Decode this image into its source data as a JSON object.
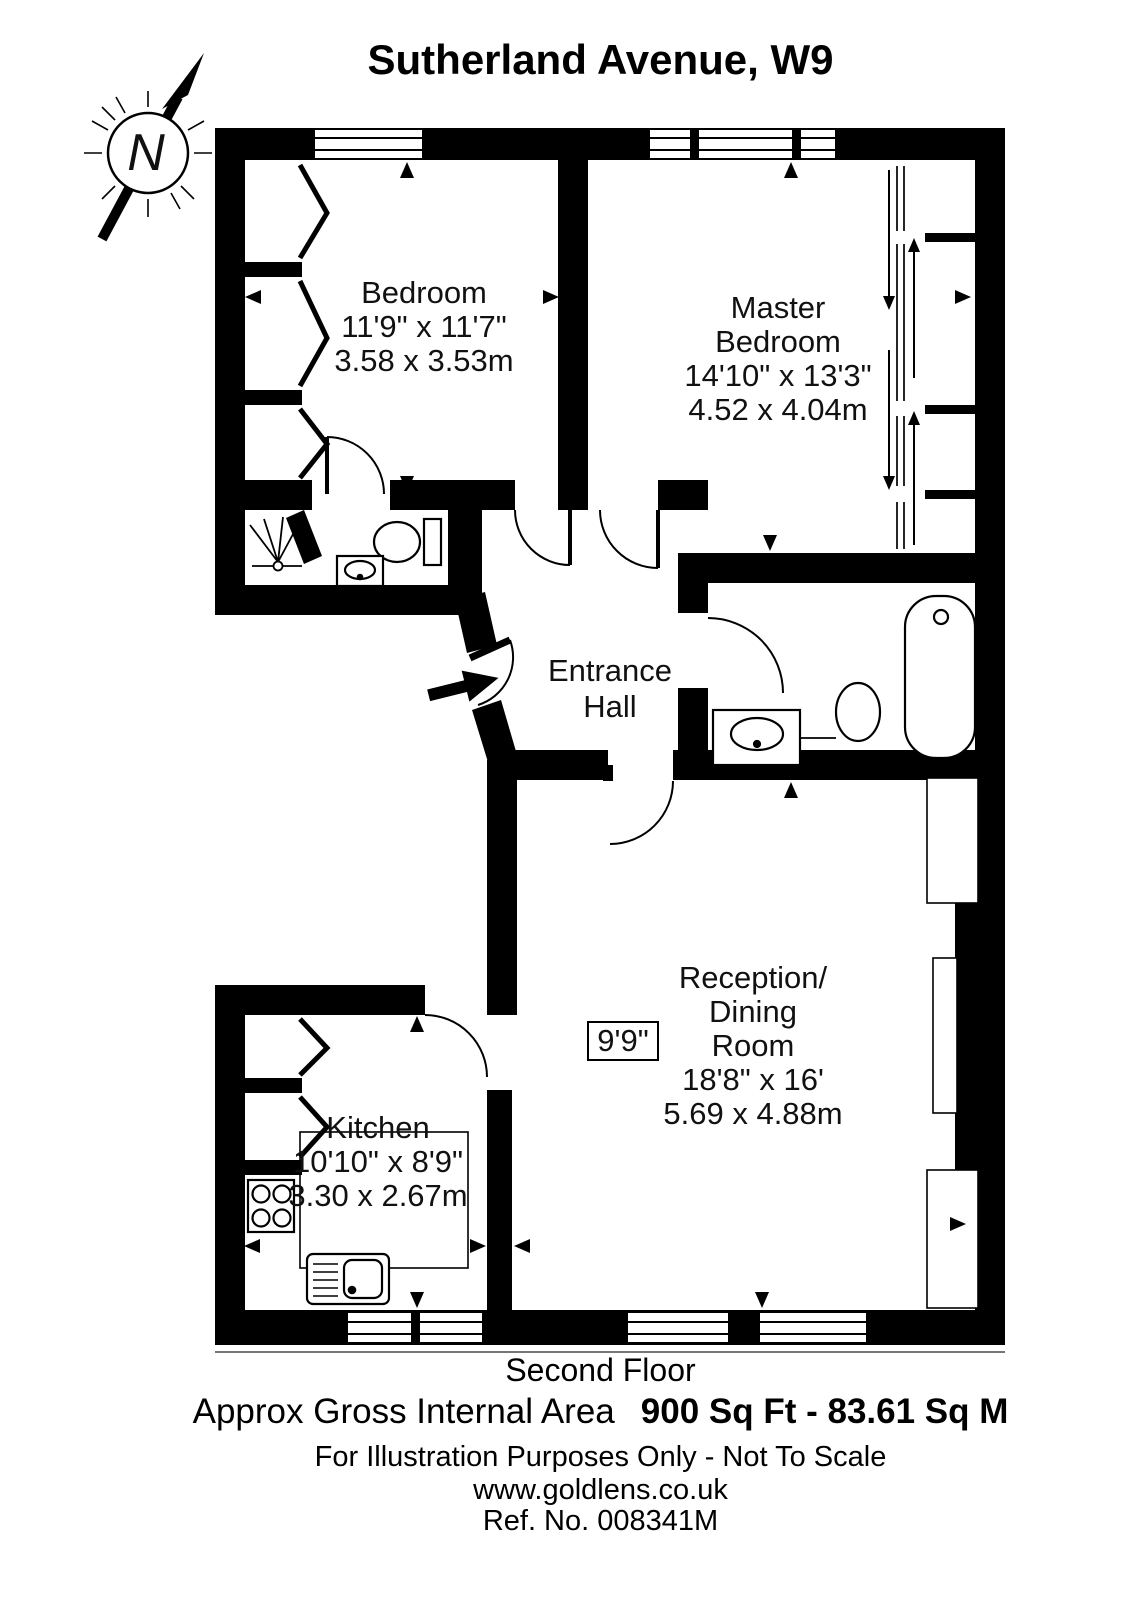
{
  "title": "Sutherland Avenue, W9",
  "compass": {
    "label": "N"
  },
  "rooms": {
    "bedroom": {
      "name": "Bedroom",
      "imperial": "11'9\" x 11'7\"",
      "metric": "3.58 x 3.53m"
    },
    "master": {
      "line1": "Master",
      "line2": "Bedroom",
      "imperial": "14'10\" x 13'3\"",
      "metric": "4.52 x 4.04m"
    },
    "hall": {
      "line1": "Entrance",
      "line2": "Hall"
    },
    "reception": {
      "line1": "Reception/",
      "line2": "Dining",
      "line3": "Room",
      "imperial": "18'8\" x 16'",
      "metric": "5.69 x 4.88m"
    },
    "kitchen": {
      "name": "Kitchen",
      "imperial": "10'10\" x 8'9\"",
      "metric": "3.30 x 2.67m"
    }
  },
  "annotations": {
    "ceiling_height": "9'9\""
  },
  "footer": {
    "floor": "Second Floor",
    "area_label": "Approx Gross Internal Area",
    "area_value": "900 Sq Ft  -  83.61 Sq M",
    "disclaimer": "For Illustration Purposes Only - Not To Scale",
    "website": "www.goldlens.co.uk",
    "reference": "Ref. No. 008341M"
  },
  "colors": {
    "wall": "#000000",
    "background": "#ffffff"
  }
}
